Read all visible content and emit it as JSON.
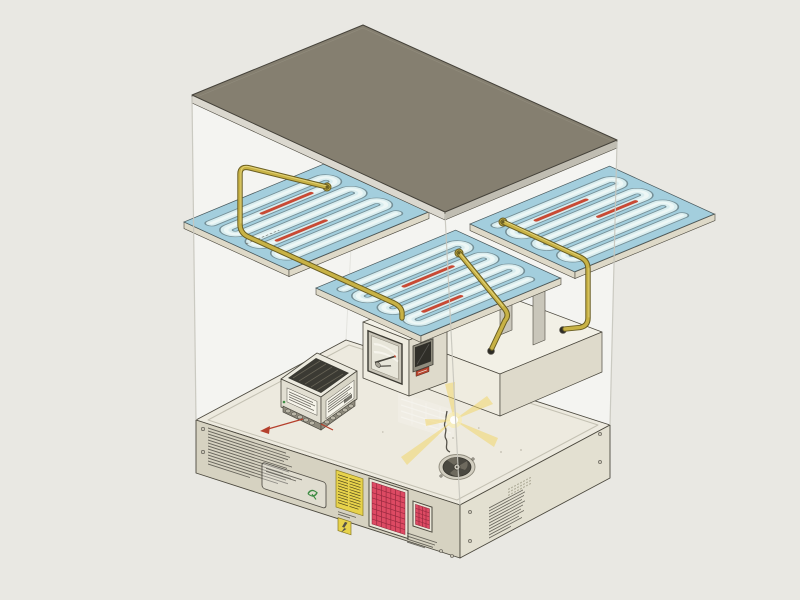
{
  "scene": {
    "description": "Exploded isometric technical illustration of a bench-top heating appliance",
    "legible_text": "none (all printed labels are illegible micro-print)"
  },
  "palette": {
    "bg": "#e9e8e3",
    "white": "#ffffff",
    "glass_line": "#c7c5bd",
    "outline_dark": "#4c493f",
    "lid_top": "#857f70",
    "lid_edge_light": "#dbd8cf",
    "lid_edge_dark": "#c0bdb2",
    "plate_blue": "#a3cedd",
    "plate_outline": "#4a5a5e",
    "channel_outline": "#6d858c",
    "channel_light": "#d9edef",
    "channel_bright": "#eef7f6",
    "plate_edge": "#ded9c8",
    "heater_red": "#c84a35",
    "brass": "#c8b245",
    "brass_dark": "#6a5e22",
    "brass_light": "#e8da83",
    "base_deck": "#edeadf",
    "base_front": "#d6d2c1",
    "base_right": "#e3e0d1",
    "unit_face": "#efece0",
    "unit_side": "#dedacb",
    "unit_top": "#f2f0e6",
    "window_dark": "#3c3a32",
    "display_dark": "#2f2e28",
    "grille_red": "#dd4a63",
    "grille_grid": "#8c2338",
    "sticker_yellow": "#e7d24b",
    "micro_ink": "#55524a",
    "green_mark": "#3e8c44",
    "ray_yellow": "#f2d35f",
    "red_wire": "#b5402c",
    "psu_vent": "#3b3a33",
    "fan_dark": "#4a4840"
  },
  "components": {
    "top_cover_plate": {
      "shape": "flat parallelogram slab",
      "color_key": "lid_top"
    },
    "heat_plates": {
      "count": 4,
      "layout": "2x2 exploded grid",
      "channel_runs_per_plate": 7,
      "channel_style": "serpentine with rounded turns",
      "heater_segments_visible": 7,
      "fittings_visible": 3
    },
    "brass_pipes": {
      "count": 3,
      "routing": "from plate fittings down into chassis units"
    },
    "glass_enclosure": {
      "visible_edges": 4
    },
    "chassis": {
      "recorder_unit": {
        "window": 1,
        "dark_display": 1,
        "red_tag": 1
      },
      "psu_module": {
        "vent": true,
        "labels": 2,
        "terminal_studs": 10,
        "red_lead": true,
        "green_led": true
      },
      "fan_assembly": {
        "blades": 3,
        "coil_spring": true
      },
      "lamp_rays": {
        "beams": 5
      },
      "mounting_plinth": {
        "support_slats": 2,
        "pipe_ports": 2
      },
      "deck_silkscreen_table": {
        "rows": 4,
        "columns": 4
      },
      "front_face": {
        "instruction_microprint_lines": 13,
        "info_label": {
          "microprint_lines": 2,
          "green_mark": true
        },
        "warning_sticker_microprint_rows": 11,
        "hazard_square_label": {
          "glyph": "lightning-bolt"
        },
        "vent_grille_large": {
          "grid": "7x8"
        },
        "vent_grille_small": {
          "grid": "4x6"
        },
        "corner_microprint_lines": 4,
        "screws": 4
      },
      "right_face": {
        "spec_microprint_lines": 11,
        "vent_dot_rows": 3,
        "screws": 4
      }
    }
  }
}
